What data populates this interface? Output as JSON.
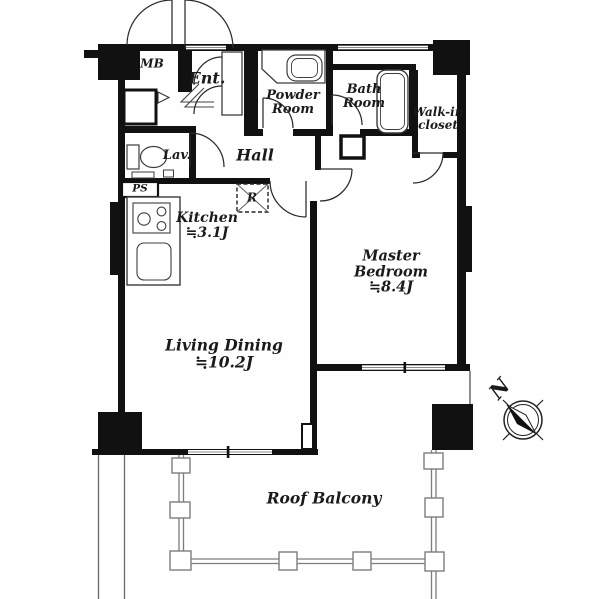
{
  "rooms": {
    "mb": {
      "label": "MB"
    },
    "entrance": {
      "label": "Ent."
    },
    "powder_room": {
      "label_line1": "Powder",
      "label_line2": "Room"
    },
    "bath_room": {
      "label_line1": "Bath",
      "label_line2": "Room"
    },
    "walk_in_closet": {
      "label_line1": "Walk-in",
      "label_line2": "closet"
    },
    "lavatory": {
      "label": "Lav."
    },
    "pipe_space": {
      "label": "PS"
    },
    "hall": {
      "label": "Hall"
    },
    "refrigerator_space": {
      "label": "R"
    },
    "kitchen": {
      "label": "Kitchen",
      "area": "≒3.1J"
    },
    "living_dining": {
      "label": "Living Dining",
      "area": "≒10.2J"
    },
    "master_bedroom": {
      "label_line1": "Master",
      "label_line2": "Bedroom",
      "area": "≒8.4J"
    },
    "roof_balcony": {
      "label": "Roof Balcony"
    }
  },
  "compass": {
    "north_label": "N"
  },
  "colors": {
    "wall": "#111111",
    "fixture_line": "#3c3c3c",
    "railing_line": "#7d7d7d"
  }
}
